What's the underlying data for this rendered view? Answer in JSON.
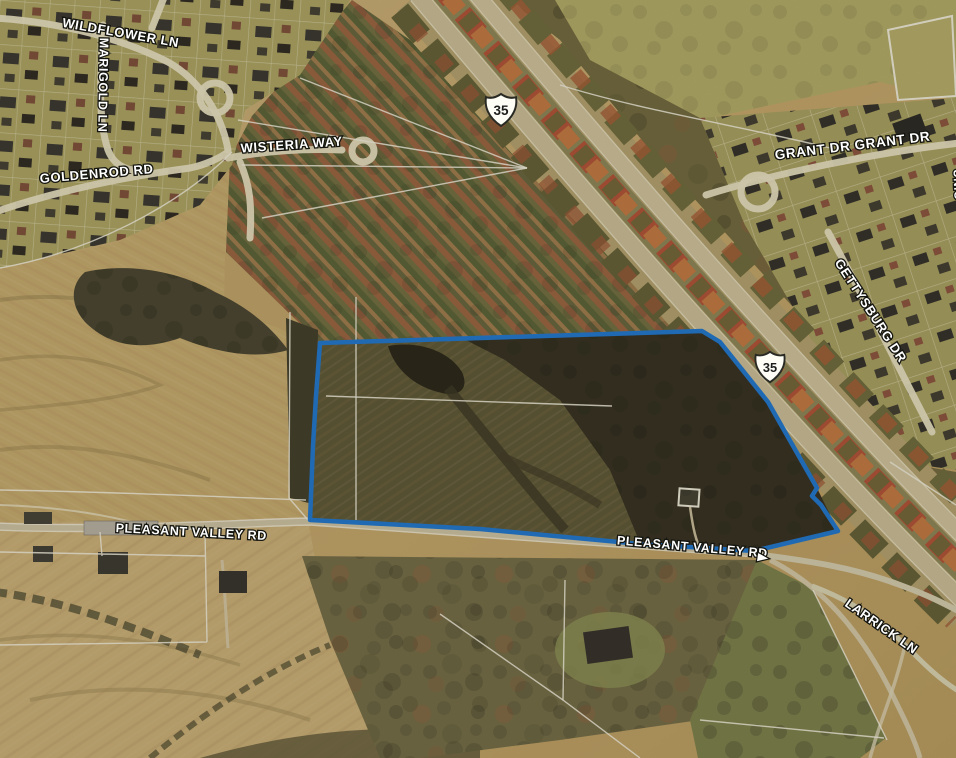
{
  "map": {
    "view_type": "aerial-parcel-map",
    "road_labels": [
      {
        "id": "wildflower-ln",
        "text": "WILDFLOWER LN"
      },
      {
        "id": "marigold-ln",
        "text": "MARIGOLD LN"
      },
      {
        "id": "goldenrod-rd",
        "text": "GOLDENROD RD"
      },
      {
        "id": "wisteria-way",
        "text": "WISTERIA WAY"
      },
      {
        "id": "grant-dr",
        "text": "GRANT DR GRANT DR"
      },
      {
        "id": "gettysburg-dr",
        "text": "GETTYSBURG DR"
      },
      {
        "id": "union-rd-partial",
        "text": "UNIO"
      },
      {
        "id": "pleasant-valley-rd-west",
        "text": "PLEASANT VALLEY RD"
      },
      {
        "id": "pleasant-valley-rd-east",
        "text": "PLEASANT VALLEY RD"
      },
      {
        "id": "larrick-ln",
        "text": "LARRICK LN"
      }
    ],
    "highway_shields": [
      {
        "route": "35"
      },
      {
        "route": "35"
      }
    ],
    "colors": {
      "parcel_outline": "#1874d2",
      "label_fill": "#ffffff",
      "label_halo": "#15150f"
    }
  }
}
